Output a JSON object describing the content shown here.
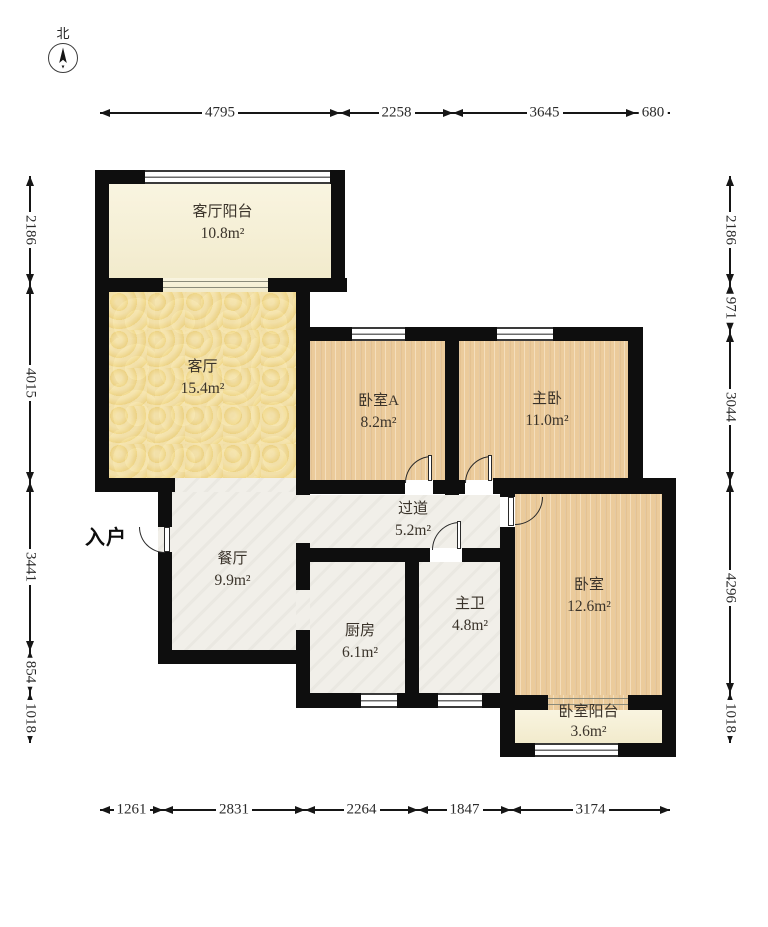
{
  "compass": {
    "label": "北"
  },
  "entrance": {
    "label": "入户"
  },
  "rooms": [
    {
      "id": "living-balcony",
      "name": "客厅阳台",
      "area": "10.8m²"
    },
    {
      "id": "living-room",
      "name": "客厅",
      "area": "15.4m²"
    },
    {
      "id": "bedroom-a",
      "name": "卧室A",
      "area": "8.2m²"
    },
    {
      "id": "master-bedroom",
      "name": "主卧",
      "area": "11.0m²"
    },
    {
      "id": "hallway",
      "name": "过道",
      "area": "5.2m²"
    },
    {
      "id": "dining-room",
      "name": "餐厅",
      "area": "9.9m²"
    },
    {
      "id": "kitchen",
      "name": "厨房",
      "area": "6.1m²"
    },
    {
      "id": "master-bath",
      "name": "主卫",
      "area": "4.8m²"
    },
    {
      "id": "bedroom",
      "name": "卧室",
      "area": "12.6m²"
    },
    {
      "id": "bedroom-balcony",
      "name": "卧室阳台",
      "area": "3.6m²"
    }
  ],
  "rulers": {
    "top": {
      "labels": [
        "4795",
        "2258",
        "3645",
        "680"
      ]
    },
    "bottom": {
      "labels": [
        "1261",
        "2831",
        "2264",
        "1847",
        "3174"
      ]
    },
    "left": {
      "labels": [
        "2186",
        "4015",
        "3441",
        "854",
        "1018"
      ]
    },
    "right": {
      "labels": [
        "2186",
        "971",
        "3044",
        "4296",
        "1018"
      ]
    }
  },
  "colors": {
    "wall": "#0e0e0e",
    "wood_floor": "#ebcb9b",
    "damask_floor": "#f3dc90",
    "cream_floor": "#f7f1d6",
    "tile_floor": "#f1efe9"
  }
}
